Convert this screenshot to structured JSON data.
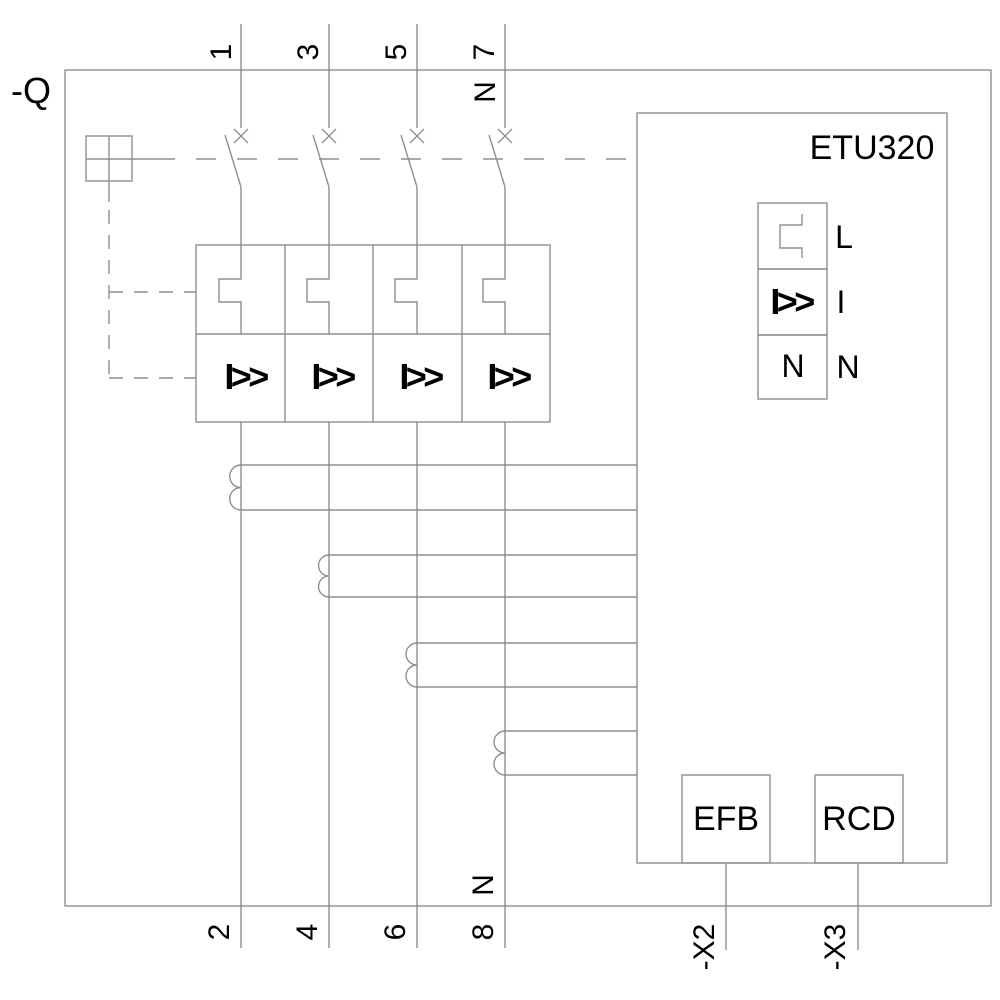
{
  "device": {
    "designation": "-Q",
    "trip_unit": "ETU320"
  },
  "terminals": {
    "top": [
      "1",
      "3",
      "5",
      "7"
    ],
    "top_neutral": "N",
    "bottom": [
      "2",
      "4",
      "6",
      "8"
    ],
    "bottom_neutral": "N",
    "aux": [
      "-X2",
      "-X3"
    ]
  },
  "trip_block": {
    "cells": [
      "I>>",
      "I>>",
      "I>>",
      "I>>"
    ]
  },
  "etu_panel": {
    "rows": [
      {
        "symbol": "long-time-step",
        "label": "L"
      },
      {
        "symbol_text": "I>>",
        "label": "I"
      },
      {
        "symbol_text": "N",
        "label": "N"
      }
    ]
  },
  "function_boxes": [
    {
      "label": "EFB"
    },
    {
      "label": "RCD"
    }
  ],
  "colors": {
    "line": "#8f8f8f",
    "text": "#000000",
    "background": "#ffffff"
  }
}
